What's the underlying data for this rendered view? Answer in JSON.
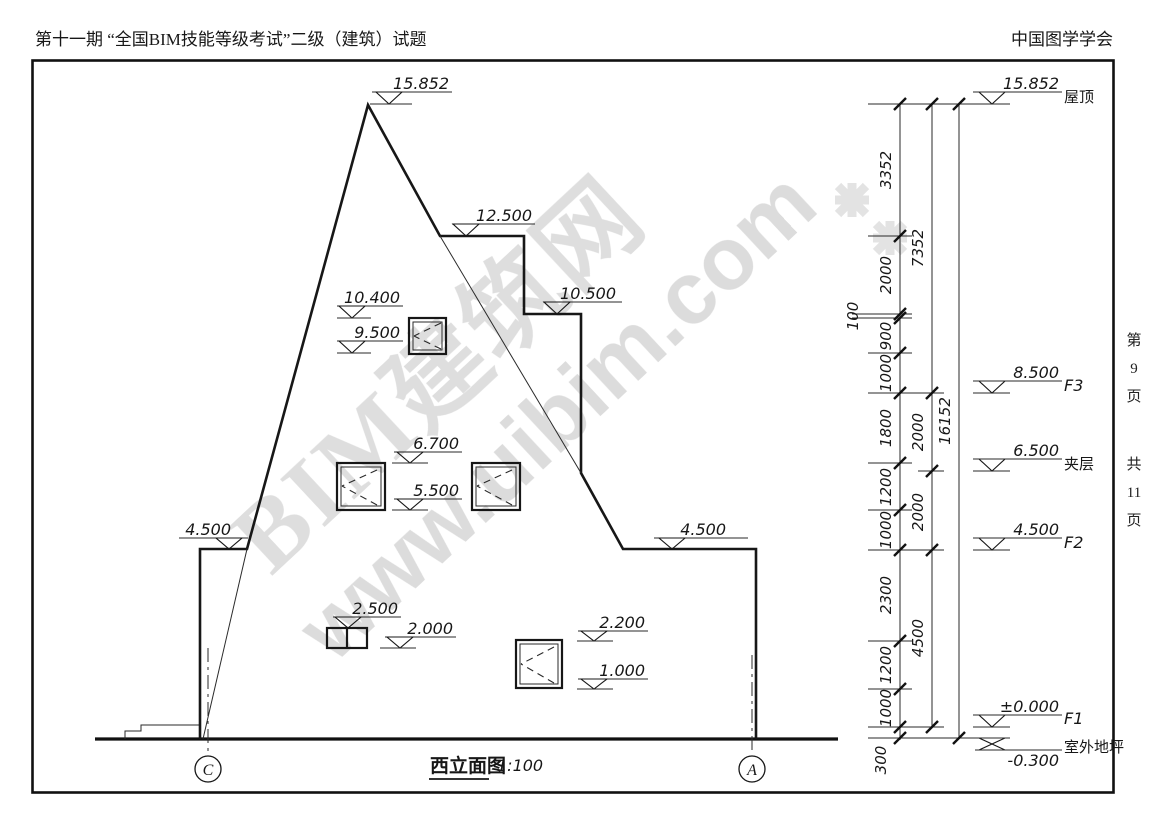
{
  "header": {
    "exam_title": "第十一期 “全国BIM技能等级考试”二级（建筑）试题",
    "organization": "中国图学学会"
  },
  "margin": {
    "page": "第\n9\n页",
    "total": "共\n11\n页"
  },
  "drawing": {
    "title": "西立面图",
    "scale": "1:100",
    "grid_bubbles": {
      "left": "C",
      "right": "A"
    },
    "watermark": {
      "line1": "BIM建筑网",
      "line2": "www.uibim.com"
    },
    "spot_elevations": {
      "peak": "15.852",
      "roof_step": "12.500",
      "tower_step": "10.500",
      "e10400": "10.400",
      "e9500": "9.500",
      "e6700": "6.700",
      "e5500": "5.500",
      "parapet_left": "4.500",
      "parapet_right": "4.500",
      "e2500": "2.500",
      "e2000": "2.000",
      "e2200": "2.200",
      "e1000": "1.000"
    },
    "levels": [
      {
        "value": "15.852",
        "label": "屋顶"
      },
      {
        "value": "8.500",
        "label": "F3"
      },
      {
        "value": "6.500",
        "label": "夹层"
      },
      {
        "value": "4.500",
        "label": "F2"
      },
      {
        "value": "±0.000",
        "label": "F1"
      },
      {
        "value": "-0.300",
        "label": "室外地坪"
      }
    ],
    "dimensions": {
      "chain_inner": [
        "3352",
        "2000",
        "100",
        "900",
        "1000",
        "1800",
        "1200",
        "1000",
        "2300",
        "1200",
        "1000",
        "300"
      ],
      "chain_middle": [
        "7352",
        "2000",
        "2000",
        "4500"
      ],
      "chain_total": [
        "16152"
      ]
    }
  }
}
